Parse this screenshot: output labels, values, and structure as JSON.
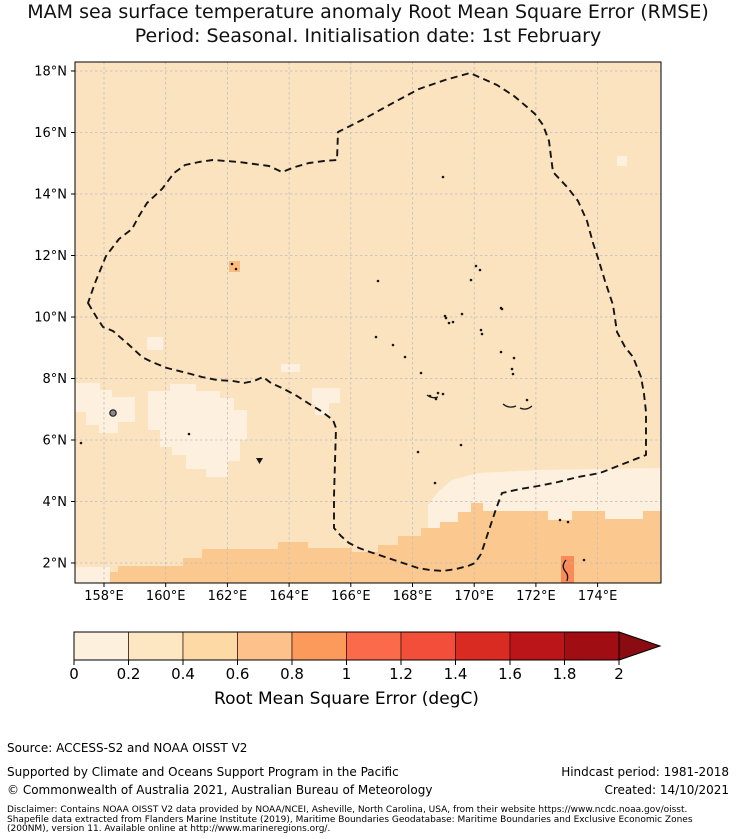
{
  "title": {
    "line1": "MAM sea surface temperature anomaly Root Mean Square Error (RMSE)",
    "line2": "Period: Seasonal. Initialisation date: 1st February"
  },
  "footer": {
    "source": "Source: ACCESS-S2 and NOAA OISST V2",
    "supported": "Supported by Climate and Oceans Support Program in the Pacific",
    "hindcast": "Hindcast period: 1981-2018",
    "copyright": "© Commonwealth of Australia 2021, Australian Bureau of Meteorology",
    "created": "Created: 14/10/2021",
    "disclaimer_line1": "Disclaimer: Contains NOAA OISST V2 data provided by NOAA/NCEI, Asheville, North Carolina, USA, from their website https://www.ncdc.noaa.gov/oisst.",
    "disclaimer_line2": "Shapefile data extracted from Flanders Marine Institute (2019), Maritime Boundaries Geodatabase: Maritime Boundaries and Exclusive Economic Zones",
    "disclaimer_line3": "(200NM), version 11. Available online at http://www.marineregions.org/."
  },
  "chart_data": {
    "type": "heatmap",
    "subtype": "geographic filled field with EEZ boundary overlay",
    "title": "MAM sea surface temperature anomaly Root Mean Square Error (RMSE). Period: Seasonal. Initialisation date: 1st February",
    "x_axis": {
      "tick_suffix": "°E",
      "ticks": [
        158,
        160,
        162,
        164,
        166,
        168,
        170,
        172,
        174
      ]
    },
    "y_axis": {
      "tick_suffix": "°N",
      "ticks": [
        18,
        16,
        14,
        12,
        10,
        8,
        6,
        4,
        2
      ]
    },
    "extent": {
      "lon_min": 157.0,
      "lon_max": 176.1,
      "lat_min": 1.4,
      "lat_max": 18.3
    },
    "field_summary": "Most of domain 0.2-0.4 degC; patches 0-0.2 degC near 157-163E/5-8N; band 0.4-0.6 degC south of ~3N; isolated higher values near islands",
    "layout": {
      "plot": {
        "x": 75,
        "y": 62,
        "w": 586,
        "h": 521
      },
      "x0": 104,
      "lon0": 158,
      "px_per_deg_x": 30.85,
      "y0": 71,
      "lat0": 18,
      "px_per_deg_y": 30.75,
      "grid": true
    },
    "colors": {
      "base": "#fce3c0",
      "light": "#fdf0de",
      "band": "#fbc98f",
      "atoll": "#fbbc7d",
      "red_island": "#f98b59",
      "grid": "#bdbdbd",
      "boundary": "#141414",
      "island": "#161616",
      "pohnpei_fill": "#8b8b8b",
      "frame": "#000000"
    },
    "colorbar": {
      "label": "Root Mean Square Error (degC)",
      "tick_labels": [
        "0",
        "0.2",
        "0.4",
        "0.6",
        "0.8",
        "1",
        "1.2",
        "1.4",
        "1.6",
        "1.8",
        "2"
      ],
      "tick_values": [
        0,
        0.2,
        0.4,
        0.6,
        0.8,
        1.0,
        1.2,
        1.4,
        1.6,
        1.8,
        2.0
      ],
      "extend": "max",
      "bin_colors": [
        "#fdf0dc",
        "#fde7c3",
        "#fdd9a6",
        "#fdc28b",
        "#fc9a5b",
        "#fb6b4b",
        "#f24e39",
        "#d92b22",
        "#bb1419",
        "#a00d13"
      ],
      "over_color": "#8a0b12",
      "geom": {
        "x": 74,
        "y": 632,
        "seg_w": 54.5,
        "h": 28,
        "arrow_w": 41,
        "tick_len": 5,
        "tick_font": 15,
        "label_font": 17
      }
    },
    "eez_boundary_px": [
      [
        88,
        303
      ],
      [
        97,
        318
      ],
      [
        103,
        327
      ],
      [
        113,
        331
      ],
      [
        128,
        344
      ],
      [
        142,
        357
      ],
      [
        152,
        362
      ],
      [
        167,
        368
      ],
      [
        187,
        373
      ],
      [
        202,
        377
      ],
      [
        217,
        380
      ],
      [
        233,
        381
      ],
      [
        244,
        383
      ],
      [
        254,
        381
      ],
      [
        263,
        377
      ],
      [
        271,
        383
      ],
      [
        284,
        389
      ],
      [
        297,
        396
      ],
      [
        311,
        405
      ],
      [
        321,
        411
      ],
      [
        333,
        420
      ],
      [
        336,
        428
      ],
      [
        335,
        462
      ],
      [
        334,
        496
      ],
      [
        334,
        528
      ],
      [
        341,
        536
      ],
      [
        349,
        543
      ],
      [
        359,
        548
      ],
      [
        370,
        552
      ],
      [
        382,
        556
      ],
      [
        394,
        560
      ],
      [
        406,
        564
      ],
      [
        418,
        568
      ],
      [
        430,
        570
      ],
      [
        443,
        571
      ],
      [
        456,
        569
      ],
      [
        468,
        566
      ],
      [
        475,
        563
      ],
      [
        481,
        554
      ],
      [
        486,
        539
      ],
      [
        491,
        524
      ],
      [
        496,
        509
      ],
      [
        502,
        493
      ],
      [
        520,
        489
      ],
      [
        538,
        486
      ],
      [
        558,
        482
      ],
      [
        578,
        477
      ],
      [
        600,
        473
      ],
      [
        623,
        464
      ],
      [
        646,
        455
      ],
      [
        646,
        431
      ],
      [
        646,
        412
      ],
      [
        644,
        394
      ],
      [
        641,
        377
      ],
      [
        633,
        357
      ],
      [
        625,
        347
      ],
      [
        617,
        332
      ],
      [
        613,
        305
      ],
      [
        605,
        281
      ],
      [
        598,
        258
      ],
      [
        593,
        243
      ],
      [
        587,
        221
      ],
      [
        578,
        201
      ],
      [
        568,
        188
      ],
      [
        553,
        172
      ],
      [
        551,
        157
      ],
      [
        549,
        141
      ],
      [
        543,
        125
      ],
      [
        535,
        114
      ],
      [
        527,
        107
      ],
      [
        514,
        96
      ],
      [
        497,
        85
      ],
      [
        470,
        73
      ],
      [
        445,
        80
      ],
      [
        419,
        89
      ],
      [
        391,
        104
      ],
      [
        362,
        120
      ],
      [
        338,
        132
      ],
      [
        337,
        160
      ],
      [
        324,
        161
      ],
      [
        309,
        163
      ],
      [
        295,
        167
      ],
      [
        282,
        172
      ],
      [
        269,
        166
      ],
      [
        254,
        164
      ],
      [
        239,
        162
      ],
      [
        226,
        161
      ],
      [
        213,
        160
      ],
      [
        199,
        162
      ],
      [
        185,
        165
      ],
      [
        174,
        173
      ],
      [
        162,
        189
      ],
      [
        147,
        203
      ],
      [
        139,
        216
      ],
      [
        132,
        229
      ],
      [
        119,
        239
      ],
      [
        106,
        256
      ],
      [
        95,
        283
      ]
    ],
    "light_patches_px": [
      [
        [
          75,
          383
        ],
        [
          100,
          383
        ],
        [
          100,
          390
        ],
        [
          112,
          390
        ],
        [
          112,
          397
        ],
        [
          135,
          397
        ],
        [
          135,
          422
        ],
        [
          118,
          422
        ],
        [
          118,
          433
        ],
        [
          99,
          433
        ],
        [
          99,
          425
        ],
        [
          86,
          425
        ],
        [
          86,
          412
        ],
        [
          75,
          412
        ]
      ],
      [
        [
          148,
          391
        ],
        [
          170,
          391
        ],
        [
          170,
          384
        ],
        [
          196,
          384
        ],
        [
          196,
          391
        ],
        [
          220,
          391
        ],
        [
          220,
          398
        ],
        [
          234,
          398
        ],
        [
          234,
          410
        ],
        [
          247,
          410
        ],
        [
          247,
          440
        ],
        [
          240,
          440
        ],
        [
          240,
          461
        ],
        [
          228,
          461
        ],
        [
          228,
          477
        ],
        [
          206,
          477
        ],
        [
          206,
          469
        ],
        [
          186,
          469
        ],
        [
          186,
          455
        ],
        [
          172,
          455
        ],
        [
          172,
          447
        ],
        [
          160,
          447
        ],
        [
          160,
          430
        ],
        [
          148,
          430
        ]
      ],
      [
        [
          147,
          337
        ],
        [
          163,
          337
        ],
        [
          163,
          350
        ],
        [
          147,
          350
        ]
      ],
      [
        [
          281,
          364
        ],
        [
          300,
          364
        ],
        [
          300,
          372
        ],
        [
          281,
          372
        ]
      ],
      [
        [
          312,
          388
        ],
        [
          340,
          388
        ],
        [
          340,
          403
        ],
        [
          329,
          403
        ],
        [
          329,
          415
        ],
        [
          315,
          415
        ],
        [
          315,
          404
        ],
        [
          312,
          404
        ]
      ],
      [
        [
          617,
          156
        ],
        [
          627,
          156
        ],
        [
          627,
          166
        ],
        [
          617,
          166
        ]
      ],
      [
        [
          428,
          505
        ],
        [
          438,
          492
        ],
        [
          452,
          480
        ],
        [
          478,
          473
        ],
        [
          540,
          470
        ],
        [
          661,
          468
        ],
        [
          661,
          545
        ],
        [
          428,
          545
        ]
      ],
      [
        [
          75,
          567
        ],
        [
          110,
          567
        ],
        [
          110,
          583
        ],
        [
          75,
          583
        ]
      ]
    ],
    "band_polygon_px": [
      [
        110,
        583
      ],
      [
        110,
        572
      ],
      [
        118,
        572
      ],
      [
        118,
        566
      ],
      [
        183,
        566
      ],
      [
        183,
        558
      ],
      [
        202,
        558
      ],
      [
        202,
        549
      ],
      [
        278,
        549
      ],
      [
        278,
        542
      ],
      [
        308,
        542
      ],
      [
        308,
        548
      ],
      [
        352,
        548
      ],
      [
        352,
        552
      ],
      [
        378,
        552
      ],
      [
        378,
        545
      ],
      [
        398,
        545
      ],
      [
        398,
        536
      ],
      [
        421,
        536
      ],
      [
        421,
        528
      ],
      [
        440,
        528
      ],
      [
        440,
        522
      ],
      [
        458,
        522
      ],
      [
        458,
        512
      ],
      [
        471,
        512
      ],
      [
        471,
        503
      ],
      [
        483,
        503
      ],
      [
        483,
        511
      ],
      [
        548,
        511
      ],
      [
        548,
        520
      ],
      [
        572,
        520
      ],
      [
        572,
        511
      ],
      [
        605,
        511
      ],
      [
        605,
        519
      ],
      [
        643,
        519
      ],
      [
        643,
        511
      ],
      [
        661,
        511
      ],
      [
        661,
        583
      ]
    ],
    "atoll_rect_px": [
      229,
      261,
      11,
      11
    ],
    "red_island_rect_px": [
      561,
      556,
      13,
      27
    ],
    "islands_px": [
      [
        443,
        177
      ],
      [
        378,
        281
      ],
      [
        471,
        280
      ],
      [
        476,
        266
      ],
      [
        480,
        270
      ],
      [
        501,
        308
      ],
      [
        446,
        318
      ],
      [
        453,
        322
      ],
      [
        481,
        330
      ],
      [
        445,
        316
      ],
      [
        462,
        314
      ],
      [
        449,
        323
      ],
      [
        502,
        309
      ],
      [
        482,
        334
      ],
      [
        501,
        352
      ],
      [
        514,
        358
      ],
      [
        512,
        369
      ],
      [
        513,
        374
      ],
      [
        430,
        396
      ],
      [
        443,
        394
      ],
      [
        436,
        399
      ],
      [
        527,
        400
      ],
      [
        376,
        337
      ],
      [
        393,
        345
      ],
      [
        405,
        357
      ],
      [
        421,
        373
      ],
      [
        438,
        393
      ],
      [
        560,
        520
      ],
      [
        568,
        522
      ],
      [
        584,
        560
      ],
      [
        81,
        443
      ],
      [
        189,
        434
      ],
      [
        232,
        264
      ],
      [
        236,
        269
      ],
      [
        418,
        452
      ],
      [
        435,
        483
      ],
      [
        461,
        445
      ]
    ],
    "island_arcs_px": [
      "M503,404 q6,5 13,2",
      "M520,408 q6,3 12,-2",
      "M427,395 q5,4 11,2",
      "M566,560 q-5,6 -1,11 q4,4 2,10"
    ],
    "pohnpei_px": {
      "x": 113,
      "y": 413,
      "r": 3.2
    },
    "triangle_islet_px": "M256,458 l7,0 l-3.5,6 z"
  }
}
